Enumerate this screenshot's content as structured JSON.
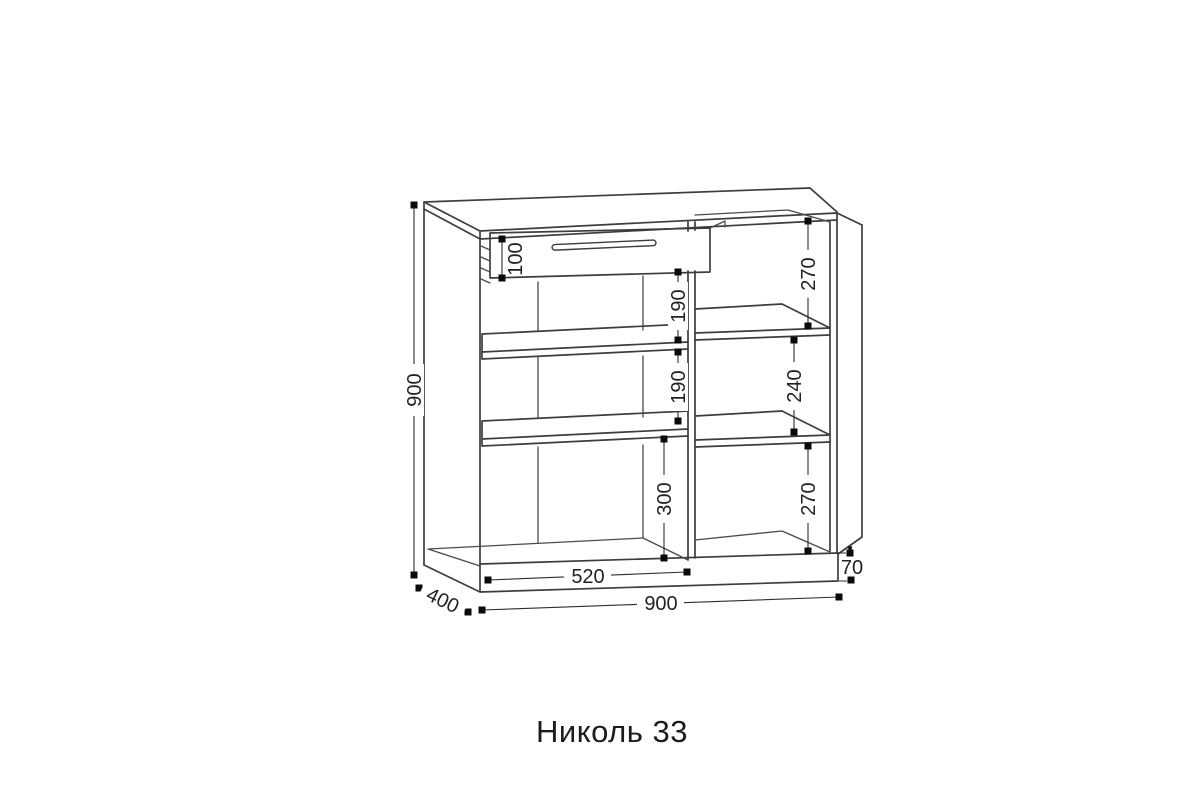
{
  "title": "Николь 33",
  "dimensions": {
    "overall_height": "900",
    "overall_width": "900",
    "overall_depth": "400",
    "drawer_front_height": "100",
    "left_opening_top": "190",
    "left_opening_middle": "190",
    "left_opening_bottom": "300",
    "right_opening_top": "270",
    "right_opening_middle": "240",
    "right_opening_bottom": "270",
    "left_section_width": "520",
    "plinth_height": "70"
  }
}
